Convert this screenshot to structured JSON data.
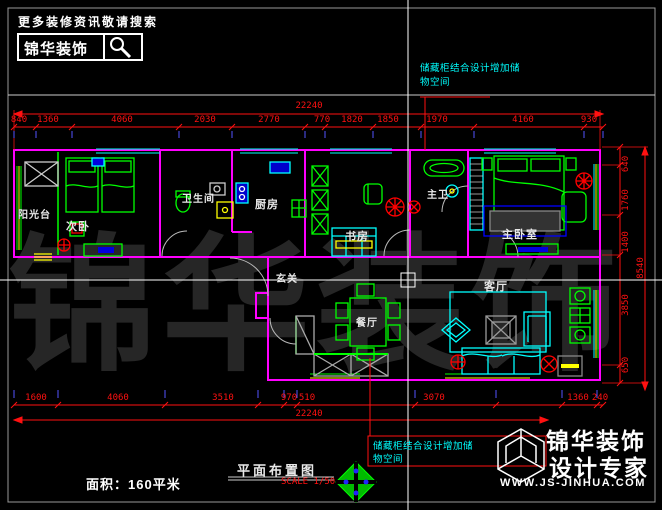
{
  "header": {
    "tagline": "更多装修资讯敬请搜索",
    "brand": "锦华装饰"
  },
  "notes": {
    "top": {
      "line1": "储藏柜结合设计增加储",
      "line2": "物空间"
    },
    "bottom": {
      "line1": "储藏柜结合设计增加储",
      "line2": "物空间"
    }
  },
  "rooms": {
    "balcony": "阳光台",
    "second_bedroom": "次卧",
    "bathroom": "卫生间",
    "kitchen": "厨房",
    "study": "书房",
    "master_bath": "主卫",
    "master_bedroom": "主卧室",
    "entry": "玄关",
    "dining": "餐厅",
    "living": "客厅"
  },
  "dimensions": {
    "top_total": "22240",
    "top_segments": [
      "840",
      "1360",
      "4060",
      "2030",
      "2770",
      "770",
      "1820",
      "1850",
      "1970",
      "4160",
      "930"
    ],
    "bottom_total": "22240",
    "bottom_segments": [
      "1600",
      "4060",
      "3510",
      "970",
      "510",
      "3070",
      "1360",
      "240"
    ],
    "right_total": "8540",
    "right_segments": [
      "640",
      "1760",
      "1400",
      "3850",
      "650"
    ]
  },
  "titleblock": {
    "area": "面积：160平米",
    "drawing_title": "平面布置图",
    "scale": "SCALE 1/50"
  },
  "brand_footer": {
    "name": "锦华装饰",
    "subtitle": "设计专家",
    "website": "WWW.JS-JINHUA.COM"
  },
  "watermark": "锦华装饰",
  "colors": {
    "wall": "#ff00ff",
    "furniture": "#00ff00",
    "dimension": "#ff0000",
    "annotation": "#00ffff",
    "highlight": "#ffff00",
    "fixture_blue": "#0000cc",
    "background": "#000000"
  }
}
